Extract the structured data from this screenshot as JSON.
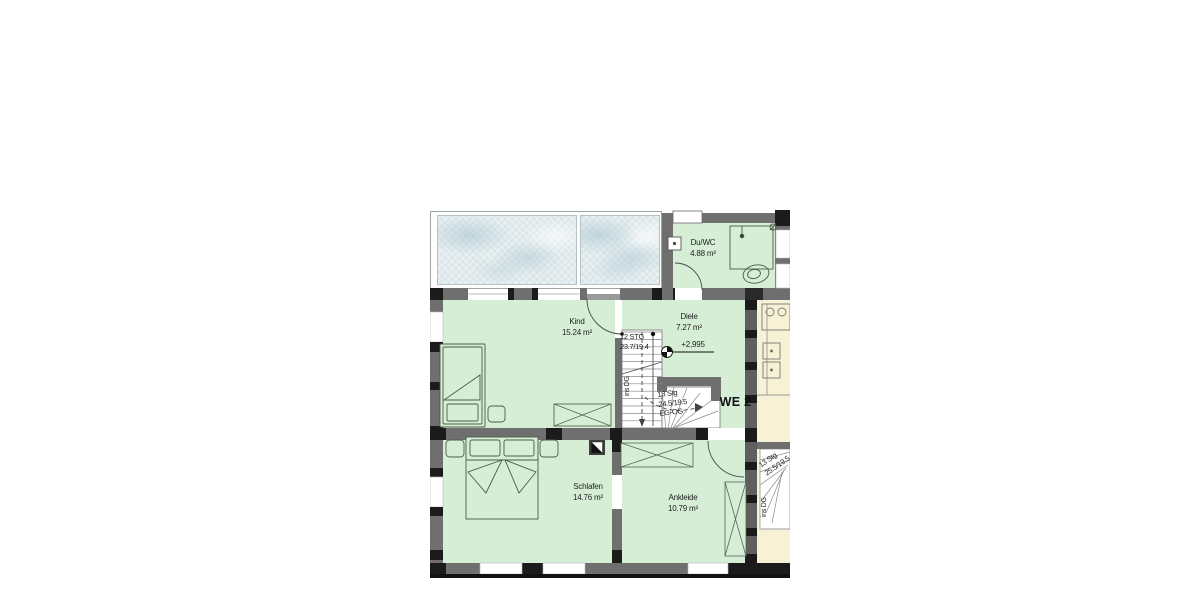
{
  "plan": {
    "unit_label": "WE 2",
    "level_marker": "+2,995",
    "rooms": {
      "duwc": {
        "name": "Du/WC",
        "area": "4.88 m²"
      },
      "kind": {
        "name": "Kind",
        "area": "15.24 m²"
      },
      "diele": {
        "name": "Diele",
        "area": "7.27 m²"
      },
      "schlafen": {
        "name": "Schlafen",
        "area": "14.76 m²"
      },
      "ankleide": {
        "name": "Ankleide",
        "area": "10.79 m²"
      }
    },
    "stairs": {
      "upper": {
        "line1": "12 STG",
        "line2": "23.7/19.4",
        "direction": "ins DG"
      },
      "lower": {
        "line1": "13 Stg",
        "line2": "24.5/19.5",
        "line3": "EG-OG"
      },
      "neighbor": {
        "line1": "13 Stg",
        "line2": "25.5/19.5",
        "direction": "ins DG"
      }
    },
    "colors": {
      "room_green": "#d6eed6",
      "neighbor_cream": "#f7f2d5",
      "wall_gray": "#6f6f6f",
      "glass_blue": "#e2ebed"
    }
  }
}
